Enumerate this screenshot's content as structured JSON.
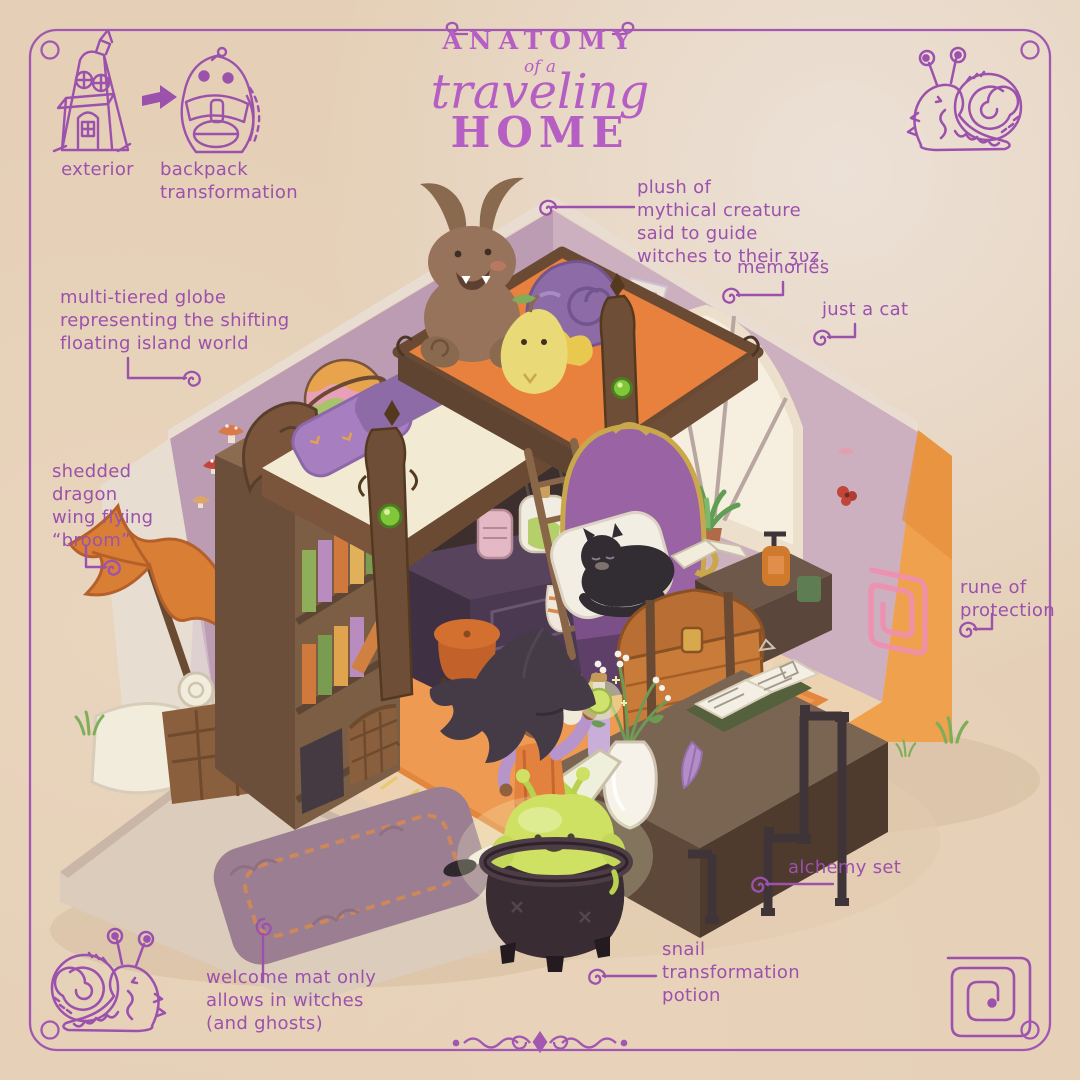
{
  "palette": {
    "background": "#e5d0b7",
    "ink_purple": "#9c51ad",
    "title_purple": "#b55fc4",
    "pink_rune": "#ef8fae",
    "wall_mauve": "#bb9cb2",
    "wall_pink": "#cdb0bf",
    "outer_wall_orange": "#f0a14e",
    "outer_wall_cream": "#e7ddd0",
    "rug_orange": "#ef9a52",
    "wood_brown": "#6f4e38",
    "armchair_purple": "#9a63a4",
    "slime_green": "#cfe163",
    "cauldron_black": "#392c33"
  },
  "title": {
    "line1": "ANATOMY",
    "line2": "of a",
    "line3": "traveling",
    "line4": "HOME"
  },
  "sketch_labels": {
    "exterior": "exterior",
    "backpack": "backpack\ntransformation"
  },
  "annotations": {
    "plush": "plush of\nmythical creature\nsaid to guide\nwitches to their ʒʋʑ.",
    "memories": "memories",
    "just_a_cat": "just a cat",
    "globe": "multi-tiered globe\nrepresenting the shifting\nfloating island world",
    "dragon_wing": "shedded\ndragon\nwing flying\n“broom”",
    "rune": "rune of\nprotection",
    "alchemy": "alchemy set",
    "snail_potion": "snail\ntransformation\npotion",
    "welcome_mat": "welcome mat only\nallows in witches\n(and ghosts)"
  },
  "scene_objects": [
    "house-exterior-sketch",
    "backpack-sketch",
    "snail-sketch-top-right",
    "snail-sketch-bottom-left",
    "spiral-rune-sketch",
    "loft-bed",
    "horned-plush-creature",
    "snail-shell-backpack",
    "winged-pear-plush",
    "memory-frames",
    "arched-window",
    "window-plant",
    "wall-mushrooms",
    "multi-tier-globe",
    "bookshelf",
    "dragon-wing-broom",
    "scroll-basket",
    "vanity-dresser",
    "potion-bottles",
    "striped-sock",
    "pouf-stool",
    "ladder",
    "armchair",
    "black-cat",
    "open-book",
    "treasure-chest",
    "alchemy-desk",
    "flower-vase",
    "spilled-flask",
    "spellbook",
    "feather-quill",
    "alchemy-pipes",
    "witch",
    "potion-vial",
    "cauldron",
    "slime-snail-creature",
    "rune-of-protection-wall",
    "welcome-mat",
    "porch",
    "orange-rug",
    "grass-tufts"
  ]
}
